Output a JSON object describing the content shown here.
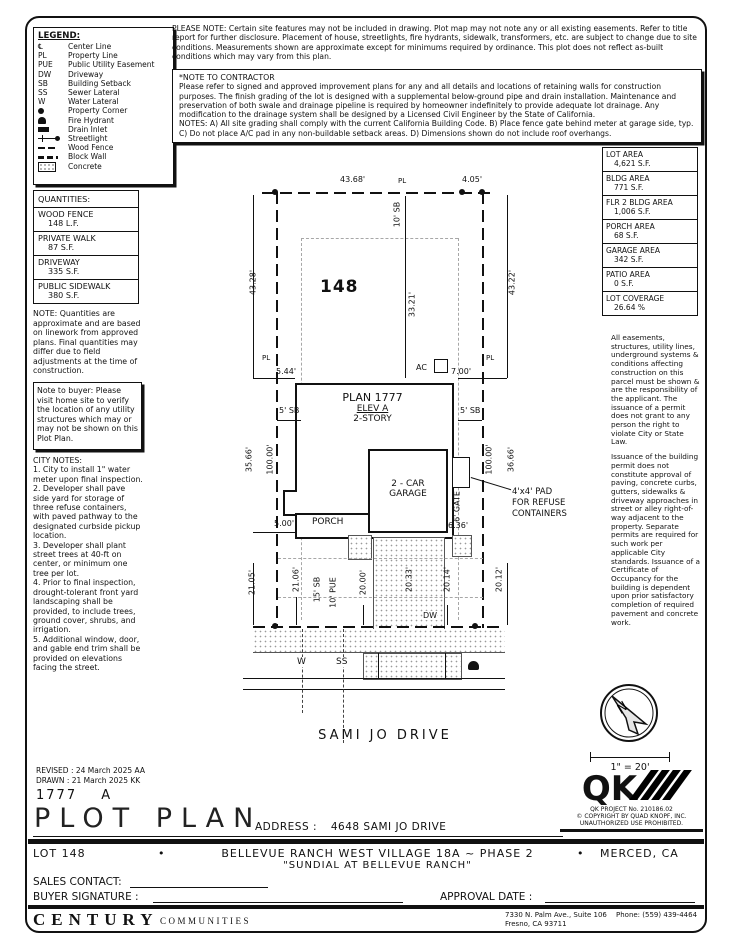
{
  "legend": {
    "title": "LEGEND:",
    "items": [
      {
        "abbr": "℄",
        "label": "Center Line"
      },
      {
        "abbr": "PL",
        "label": "Property Line"
      },
      {
        "abbr": "PUE",
        "label": "Public Utility Easement"
      },
      {
        "abbr": "DW",
        "label": "Driveway"
      },
      {
        "abbr": "SB",
        "label": "Building Setback"
      },
      {
        "abbr": "SS",
        "label": "Sewer Lateral"
      },
      {
        "abbr": "W",
        "label": "Water Lateral"
      },
      {
        "abbr": "",
        "label": "Property Corner",
        "icon": "property-corner"
      },
      {
        "abbr": "",
        "label": "Fire Hydrant",
        "icon": "fire-hydrant"
      },
      {
        "abbr": "",
        "label": "Drain Inlet",
        "icon": "drain-inlet"
      },
      {
        "abbr": "",
        "label": "Streetlight",
        "icon": "streetlight"
      },
      {
        "abbr": "",
        "label": "Wood Fence",
        "icon": "wood-fence"
      },
      {
        "abbr": "",
        "label": "Block Wall",
        "icon": "block-wall"
      },
      {
        "abbr": "",
        "label": "Concrete",
        "icon": "concrete"
      }
    ]
  },
  "please_note": "PLEASE NOTE:  Certain site features may not be included in drawing. Plot map may not note any or all existing easements. Refer to title report for further disclosure. Placement of house, streetlights, fire hydrants, sidewalk, transformers, etc. are subject to change due to site conditions. Measurements shown are approximate except for minimums required by ordinance. This plot does not reflect as-built conditions which may vary from this plan.",
  "contractor": {
    "title": "*NOTE TO CONTRACTOR",
    "body": "Please refer to signed and approved improvement plans for any and all details and locations of retaining walls for construction purposes. The finish grading of the lot is designed with a supplemental below-ground pipe and drain installation. Maintenance and preservation of both swale and drainage pipeline is required by homeowner indefinitely to provide adequate lot drainage. Any modification to the drainage system shall be designed by a Licensed Civil Engineer by the State of California.",
    "notes": "NOTES:  A) All site grading shall comply with the current California Building Code.  B) Place fence gate behind meter at garage side, typ. C) Do not place A/C pad in any non-buildable setback areas.  D) Dimensions shown do not include roof overhangs."
  },
  "quantities": {
    "title": "QUANTITIES:",
    "items": [
      {
        "name": "WOOD FENCE",
        "value": "148 L.F."
      },
      {
        "name": "PRIVATE WALK",
        "value": "87 S.F."
      },
      {
        "name": "DRIVEWAY",
        "value": "335 S.F."
      },
      {
        "name": "PUBLIC SIDEWALK",
        "value": "380 S.F."
      }
    ],
    "note": "NOTE: Quantities are approximate and are based on linework from approved plans.  Final quantities may differ due to field adjustments at the time of construction."
  },
  "buyer_note": "Note to buyer: Please visit home site to verify the location of any utility structures which may or may not be shown on this Plot Plan.",
  "city_notes": {
    "title": "CITY NOTES:",
    "items": [
      "1. City to install 1\" water meter upon final inspection.",
      "2. Developer shall pave side yard for storage of three refuse containers, with paved pathway to the designated curbside pickup location.",
      "3. Developer shall plant street trees at 40-ft on center, or minimum one tree per lot.",
      "4. Prior to final inspection, drought-tolerant front yard landscaping shall be provided, to include trees, ground cover, shrubs, and irrigation.",
      "5. Additional window, door, and gable end trim shall be provided on elevations facing the street."
    ]
  },
  "areas": [
    {
      "label": "LOT AREA",
      "value": "4,621 S.F."
    },
    {
      "label": "BLDG AREA",
      "value": "771 S.F."
    },
    {
      "label": "FLR 2 BLDG AREA",
      "value": "1,006 S.F."
    },
    {
      "label": "PORCH AREA",
      "value": "68 S.F."
    },
    {
      "label": "GARAGE AREA",
      "value": "342 S.F."
    },
    {
      "label": "PATIO AREA",
      "value": "0 S.F."
    },
    {
      "label": "LOT COVERAGE",
      "value": "26.64 %"
    }
  ],
  "right_notes": {
    "para1": "All easements, structures, utility lines, underground systems & conditions affecting construction on this parcel must be shown & are the responsibility of the applicant. The issuance of a permit does not grant to any person the right to violate City or State Law.",
    "para2": "Issuance of the building permit does not constitute approval of paving, concrete curbs, gutters, sidewalks & driveway approaches in street or alley right-of-way adjacent to the property. Separate permits are required for such work per applicable City standards. Issuance of a Certificate of Occupancy for the building is dependent upon prior satisfactory completion of required pavement and concrete work."
  },
  "plot": {
    "lot_number": "148",
    "labels": {
      "pl": "PL",
      "plan": "PLAN 1777",
      "elev": "ELEV A",
      "story": "2-STORY",
      "garage_line1": "2 - CAR",
      "garage_line2": "GARAGE",
      "porch": "PORCH",
      "ac": "AC",
      "gate": "6' GATE",
      "dw": "DW",
      "w": "W",
      "ss": "SS",
      "street": "SAMI JO DRIVE",
      "refuse_line1": "4'x4' PAD",
      "refuse_line2": "FOR REFUSE",
      "refuse_line3": "CONTAINERS"
    },
    "dims": {
      "lot_width_rear": "43.68'",
      "rear_jog": "4.05'",
      "rear_setback": "10' SB",
      "depth_left_outer": "43.28'",
      "depth_right_outer": "43.22'",
      "rear_yard_depth": "33.21'",
      "side_left": "5.44'",
      "side_right": "7.00'",
      "side_setback": "5' SB",
      "left_house_offset": "35.66'",
      "left_pl_length": "100.00'",
      "right_pl_length": "100.00'",
      "right_house_offset": "36.66'",
      "porch_offset": "5.00'",
      "gate_offset": "6.36'",
      "front_left_outer": "21.05'",
      "front_left": "21.06'",
      "front_setback": "15' SB",
      "pue": "10' PUE",
      "front_walk": "20.00'",
      "front_drive": "20.33'",
      "front_right": "20.14'",
      "front_right_outer": "20.12'",
      "frontage": "44.74'"
    }
  },
  "compass": {
    "n": "N",
    "scale": "1\" = 20'"
  },
  "title_block": {
    "revised": "REVISED :  24 March 2025  AA",
    "drawn": "DRAWN :  21 March 2025  KK",
    "plan_id": "1777",
    "plan_rev": "A",
    "title": "PLOT PLAN",
    "address_label": "ADDRESS :",
    "address_value": "4648 SAMI JO DRIVE"
  },
  "qk": {
    "logo": "QK",
    "project": "QK PROJECT No. 210186.02",
    "copyright": "© COPYRIGHT BY QUAD KNOPF, INC.",
    "notice": "UNAUTHORIZED USE PROHIBITED."
  },
  "project_row": {
    "lot": "LOT 148",
    "bullet": "•",
    "name": "BELLEVUE RANCH WEST VILLAGE 18A ~ PHASE 2",
    "city": "MERCED, CA",
    "subtitle": "\"SUNDIAL AT BELLEVUE RANCH\""
  },
  "signatures": {
    "sales": "SALES CONTACT:",
    "buyer": "BUYER SIGNATURE :",
    "approval": "APPROVAL DATE :"
  },
  "footer": {
    "brand_main": "CENTURY",
    "brand_sub": "COMMUNITIES",
    "addr1": "7330 N. Palm Ave., Suite 106",
    "phone": "Phone:  (559) 439-4464",
    "addr2": "Fresno, CA  93711"
  }
}
